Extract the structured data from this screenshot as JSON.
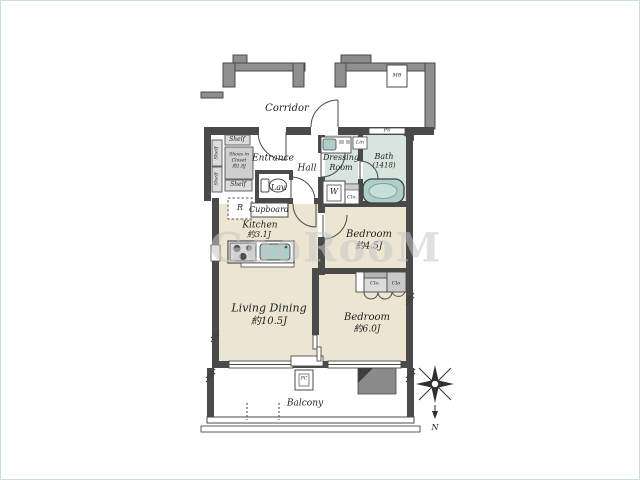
{
  "colors": {
    "wall": "#4a4a4a",
    "corridor_wall": "#8f8f8f",
    "floor_beige": "#ece5d2",
    "wet_area": "#d8e5df",
    "fixture_teal": "#aecfc8",
    "closet_gray": "#dcdcdc",
    "watermark_gray": "#c6c6c6"
  },
  "floor_plan": {
    "watermark": "GooRooM",
    "corridor": {
      "label": "Corridor",
      "meter_box_label": "MB"
    },
    "entrance": {
      "label": "Entrance",
      "shelf_top": "Shelf",
      "shelf_bottom": "Shelf",
      "shelf_side_upper": "Shelf",
      "shelf_side_lower": "Shelf",
      "shoes_closet_line1": "Shoes in",
      "shoes_closet_line2": "Closet",
      "shoes_closet_line3": "約1.8J"
    },
    "hall": {
      "label": "Hall"
    },
    "lavatory": {
      "label": "Lav."
    },
    "kitchen": {
      "label": "Kitchen",
      "size": "約3.1J",
      "refrigerator_label": "R",
      "cupboard_label": "Cupboard"
    },
    "living_dining": {
      "label": "Living Dining",
      "size": "約10.5J"
    },
    "bedroom_small": {
      "label": "Bedroom",
      "size": "約4.5J"
    },
    "bedroom_large": {
      "label": "Bedroom",
      "size": "約6.0J",
      "closet_left_label": "Clo.",
      "closet_right_label": "Clo"
    },
    "dressing_room": {
      "label_line1": "Dressing",
      "label_line2": "Room",
      "washer_label": "W",
      "linen_label": "Lin",
      "closet_label": "Clo."
    },
    "bath": {
      "label": "Bath",
      "size": "(1418)",
      "pipe_space_label": "PS"
    },
    "balcony": {
      "label": "Balcony",
      "box_label": "PC"
    },
    "compass": {
      "north_label": "N"
    }
  }
}
